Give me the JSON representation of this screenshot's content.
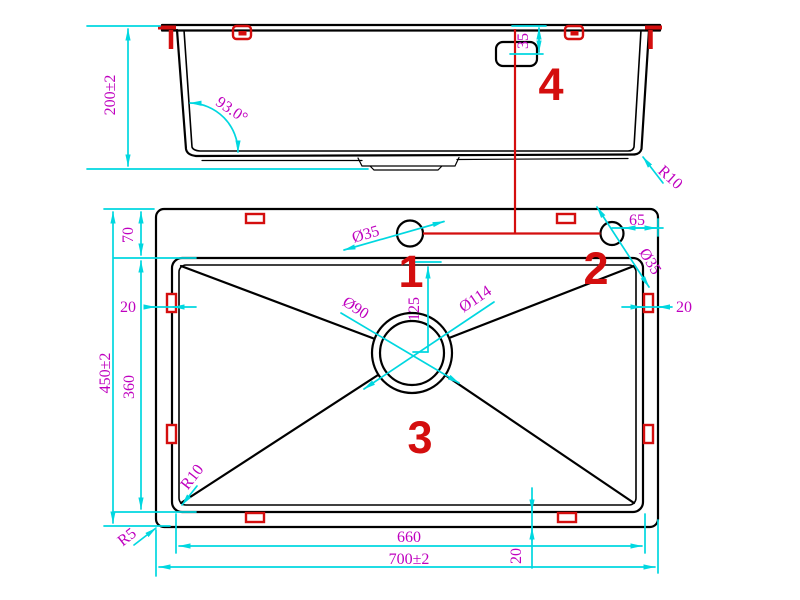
{
  "drawing_title": "sink-technical-drawing",
  "colors": {
    "outline": "#000000",
    "dimension_line": "#00d7e0",
    "dimension_text": "#bf00bf",
    "highlight": "#d40e0e",
    "background": "#ffffff"
  },
  "side_view": {
    "feature4": "4",
    "dims": {
      "depth": "200±2",
      "wall_angle": "93.0°",
      "overflow_offset": "35",
      "bottom_corner_radius": "R10"
    }
  },
  "plan_view": {
    "feature1": "1",
    "feature2": "2",
    "feature3": "3",
    "dims": {
      "rim_to_bowl": "70",
      "edge_left": "20",
      "overall_height": "450±2",
      "bowl_depth": "360",
      "bowl_corner_radius": "R10",
      "outer_corner_radius": "R5",
      "bowl_width": "660",
      "overall_width": "700±2",
      "edge_bottom": "20",
      "edge_right": "20",
      "hole_to_edge": "65",
      "faucet_hole_dia": "Ø35",
      "accessory_hole_dia": "Ø35",
      "drain_inner_dia": "Ø90",
      "drain_outer_dia": "Ø114",
      "drain_offset": "125"
    }
  }
}
